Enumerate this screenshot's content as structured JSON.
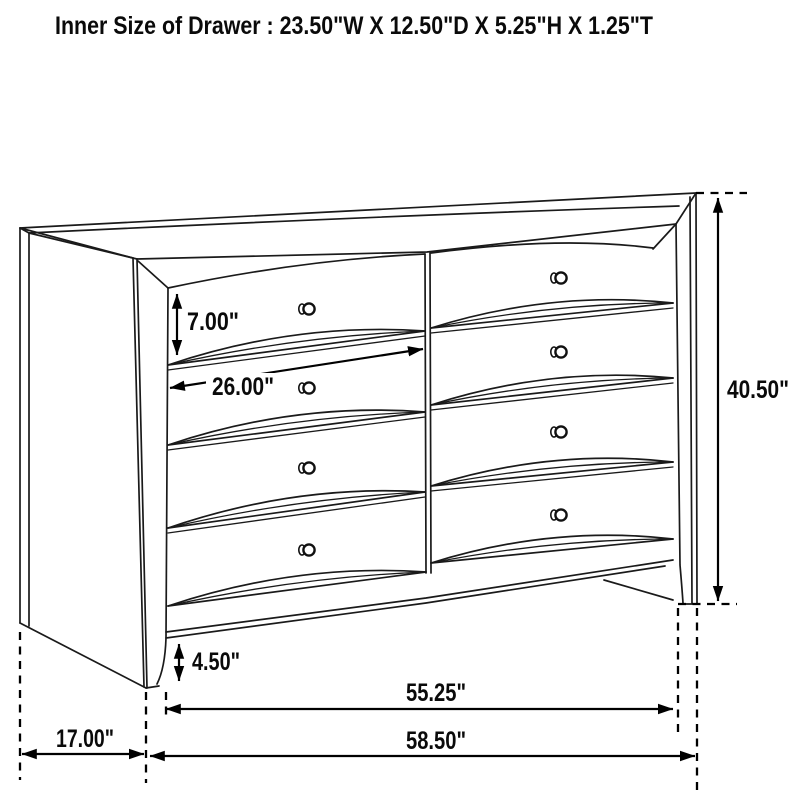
{
  "title": "Inner Size of Drawer : 23.50\"W X 12.50\"D X 5.25\"H X 1.25\"T",
  "dimensions": {
    "drawer_front_height": "7.00\"",
    "drawer_width": "26.00\"",
    "overall_height": "40.50\"",
    "base_height": "4.50\"",
    "inner_width": "55.25\"",
    "overall_width": "58.50\"",
    "side_depth": "17.00\""
  }
}
